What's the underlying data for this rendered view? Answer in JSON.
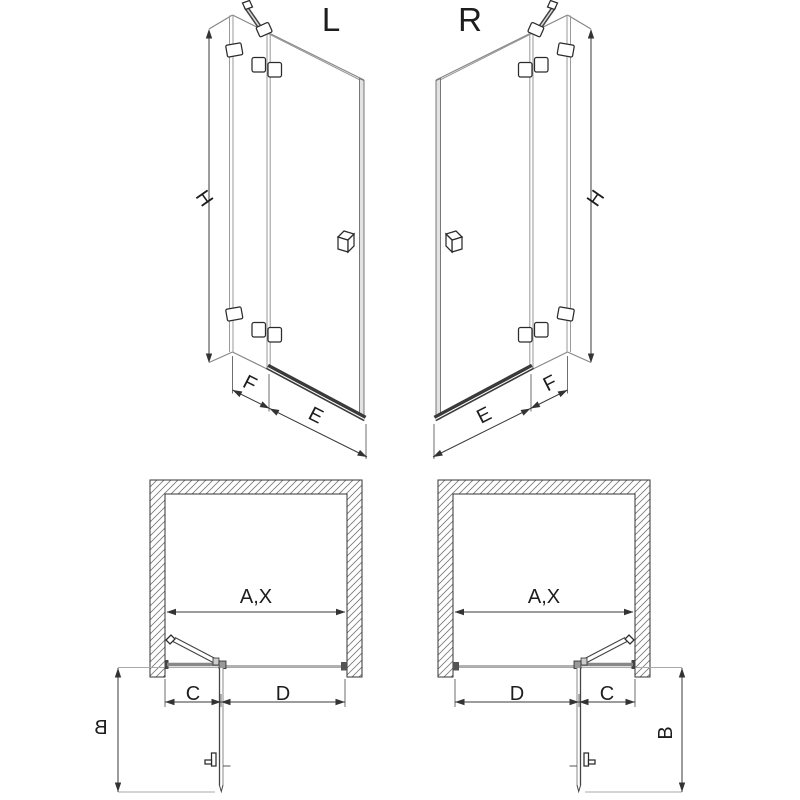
{
  "title": "shower-door-installation-diagram",
  "colors": {
    "background": "#ffffff",
    "line": "#3a3a3a",
    "glass_line": "#999999",
    "rail": "#3a3a3a",
    "wall_hatch": "#777777"
  },
  "views": {
    "left": {
      "label": "L",
      "height_dim": "H",
      "fixed_panel_dim": "F",
      "door_width_dim": "E",
      "opening_dim": "A,X",
      "hinge_side_dim": "C",
      "door_side_dim": "D",
      "door_projection_dim": "B"
    },
    "right": {
      "label": "R",
      "height_dim": "H",
      "fixed_panel_dim": "F",
      "door_width_dim": "E",
      "opening_dim": "A,X",
      "hinge_side_dim": "C",
      "door_side_dim": "D",
      "door_projection_dim": "B"
    }
  }
}
